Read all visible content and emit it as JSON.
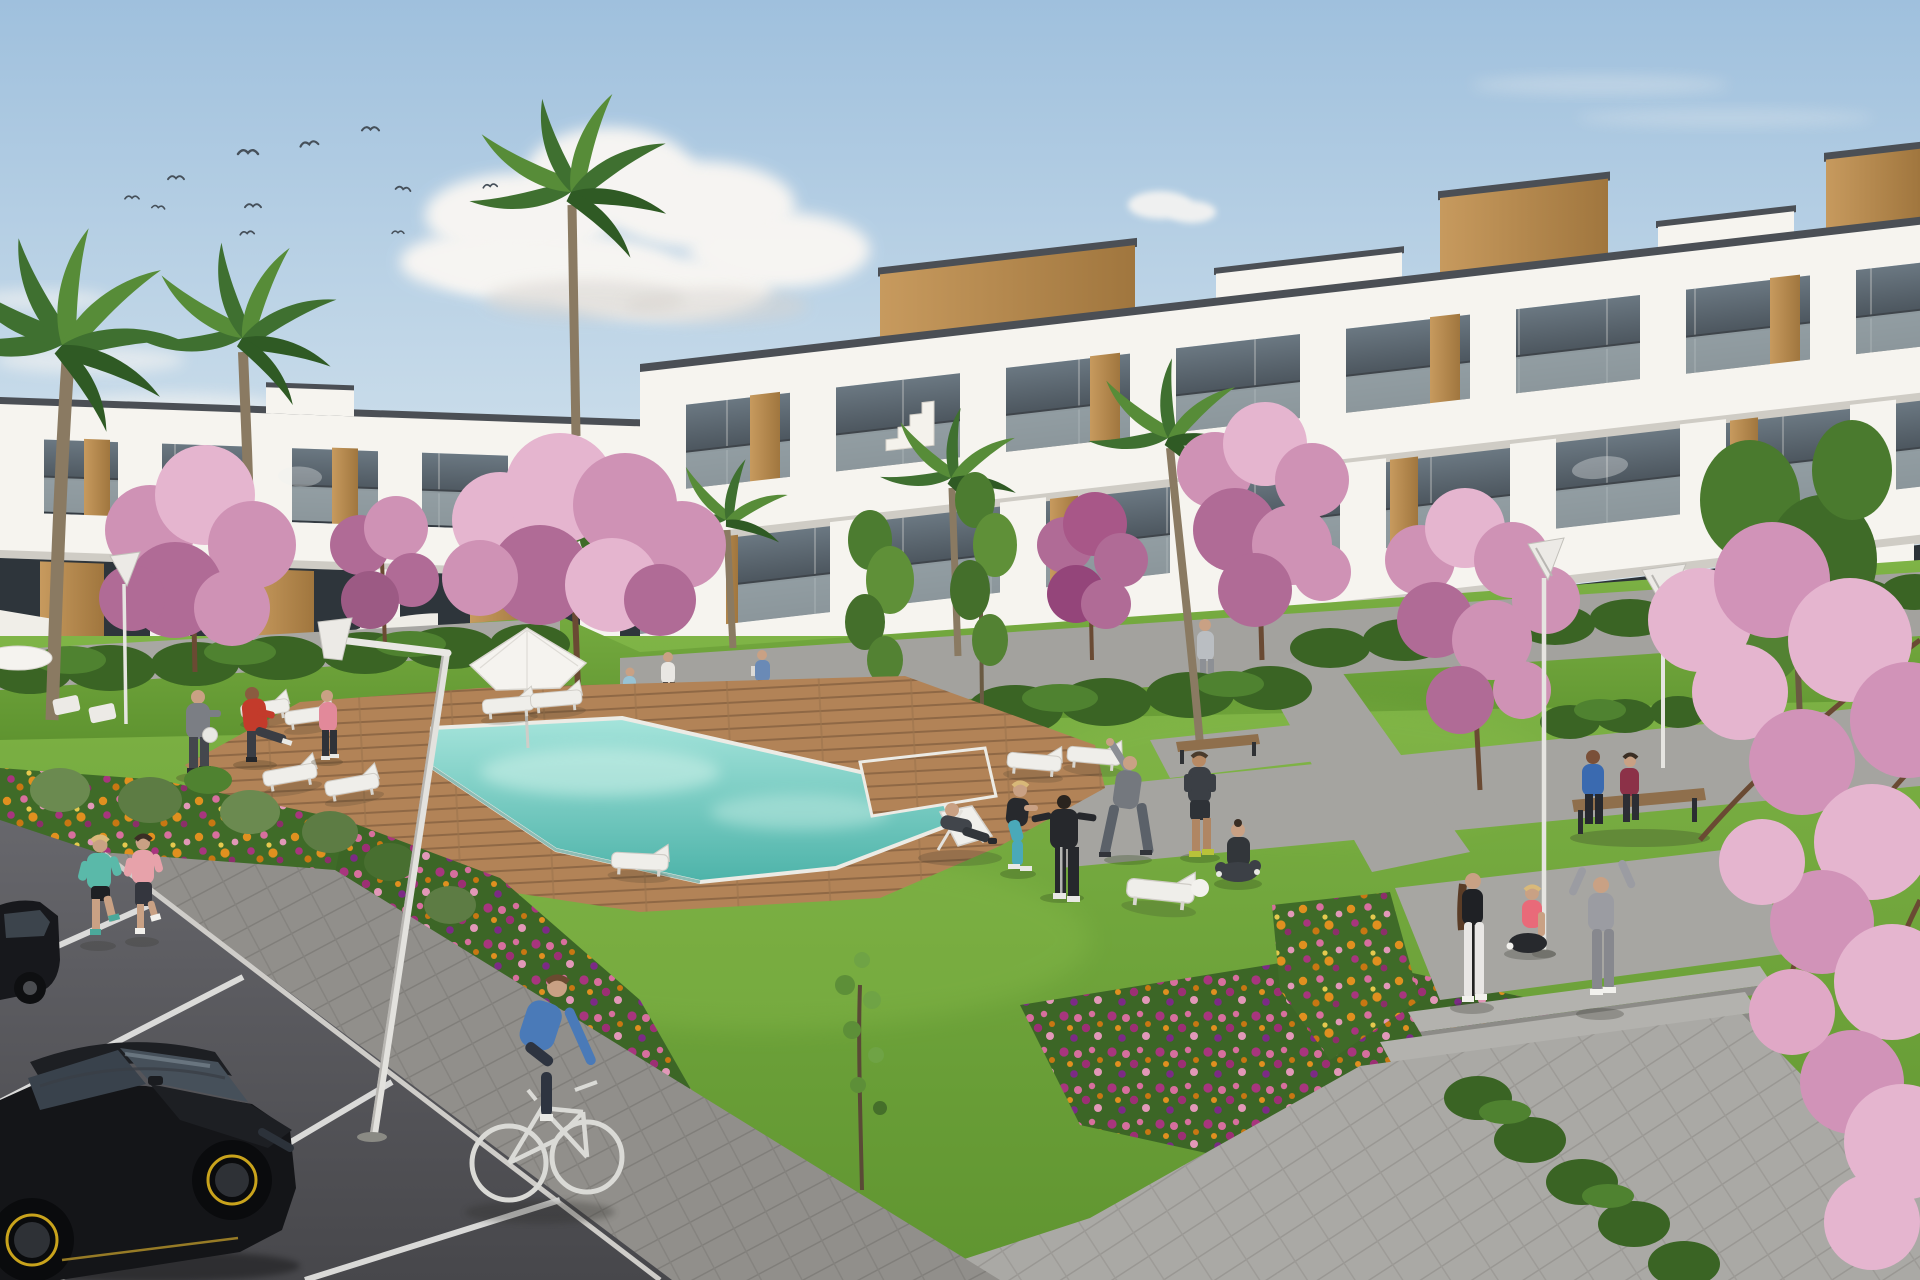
{
  "scene": {
    "type": "architectural-3d-rendering",
    "description": "Daytime 3D visualization of a modern white apartment complex with wood-clad accents, glass balconies, communal lawn, turquoise swimming pool with timber deck, flower beds, palm and cherry-blossom trees, a parking lane with black cars, joggers, a cyclist and residents exercising",
    "weather": "sunny, mostly clear sky",
    "bird_count": 11,
    "people_count": 21,
    "lounger_count": 9,
    "street_lamp_count": 4,
    "building_left_stories": 2,
    "building_right_stories": 3
  },
  "palette": {
    "sky_top": "#9fc0dd",
    "sky_mid": "#c9dcea",
    "sky_low": "#e9eff3",
    "cloud": "#faf7f3",
    "bird": "#46505a",
    "bldg_white": "#f6f4ef",
    "roof_cap": "#4b4f55",
    "wood": "#c79a5e",
    "wood_dark": "#a0763e",
    "glass_dark": "#333a41",
    "glass_mid": "#6b7882",
    "rail_glass": "#a9b5b9",
    "grass": "#5f9430",
    "grass_light": "#7fb446",
    "hedge": "#3a6424",
    "hedge_light": "#4f8230",
    "deck": "#b28357",
    "deck_line": "#8f6845",
    "pool_far": "#a5e4db",
    "pool_near": "#4db3a9",
    "coping": "#ecebe5",
    "path": "#918f8b",
    "path_light": "#aaa9a5",
    "road_top": "#67676c",
    "road_bottom": "#47474b",
    "road_line": "#e9e9e7",
    "flower_orange": "#e0901f",
    "flower_pink": "#d76f9e",
    "flower_magenta": "#a8357e",
    "flower_yellow": "#e5c94e",
    "foliage": "#3f6b28",
    "blossom_light": "#e5b5cf",
    "blossom_mid": "#cf92b5",
    "blossom_red": "#b06b96",
    "palm": "#3f7030",
    "palm_light": "#578c38",
    "trunk": "#8a7a62",
    "lamp_white": "#eceae6",
    "umbrella": "#f5f3ef",
    "bench_wood": "#8f6f4c",
    "skin": "#c9a184"
  },
  "car": {
    "body": "#141518",
    "glass": "#46505a",
    "trim": "#1d1f23",
    "rim_accent": "#c9a31c"
  },
  "car_partial": {
    "body": "#17181c"
  },
  "people": [
    {
      "id": "ball-man-grey",
      "shirt": "#7b7e84",
      "pants": "#44474d"
    },
    {
      "id": "ball-man-red",
      "shirt": "#c33b2b",
      "pants": "#3a3d44"
    },
    {
      "id": "ball-woman-pink",
      "shirt": "#e2899a",
      "pants": "#2f3238"
    },
    {
      "id": "walker-lightblue",
      "shirt": "#98c3d4",
      "pants": "#4a4d52"
    },
    {
      "id": "walker-white",
      "shirt": "#e9e7e3",
      "pants": "#3a3d42"
    },
    {
      "id": "walker-bag",
      "shirt": "#6a8ab6",
      "pants": "#3c3f44"
    },
    {
      "id": "walker-grey",
      "shirt": "#babec2",
      "pants": "#8d9095"
    },
    {
      "id": "deckchair-man",
      "shirt": "#41454b",
      "pants": "#32363b"
    },
    {
      "id": "squat-woman",
      "shirt": "#27292d",
      "pants": "#4aa9b9"
    },
    {
      "id": "tracksuit-person",
      "shirt": "#26282c",
      "pants": "#26282c"
    },
    {
      "id": "stretch-man",
      "shirt": "#74787e",
      "pants": "#5b6169"
    },
    {
      "id": "shorts-man",
      "shirt": "#3b3f45",
      "pants": "#2e3237"
    },
    {
      "id": "yoga-woman",
      "shirt": "#32363a",
      "pants": "#3c4046"
    },
    {
      "id": "jogger-teal",
      "shirt": "#5ab9a9",
      "pants": "#1e2024"
    },
    {
      "id": "jogger-pink",
      "shirt": "#e7a2aa",
      "pants": "#34363e"
    },
    {
      "id": "cyclist",
      "shirt": "#4a7ab8",
      "pants": "#2e3440"
    },
    {
      "id": "bench-man",
      "shirt": "#3a6ab0",
      "pants": "#26282e"
    },
    {
      "id": "bench-woman",
      "shirt": "#8c3148",
      "pants": "#2c2e34"
    },
    {
      "id": "standing-woman",
      "shirt": "#1f2125",
      "pants": "#e9e7e5"
    },
    {
      "id": "sitting-woman-pink",
      "shirt": "#e96a79",
      "pants": "#27292d"
    },
    {
      "id": "armsup-person",
      "shirt": "#9b9ca2",
      "pants": "#87888e"
    }
  ]
}
